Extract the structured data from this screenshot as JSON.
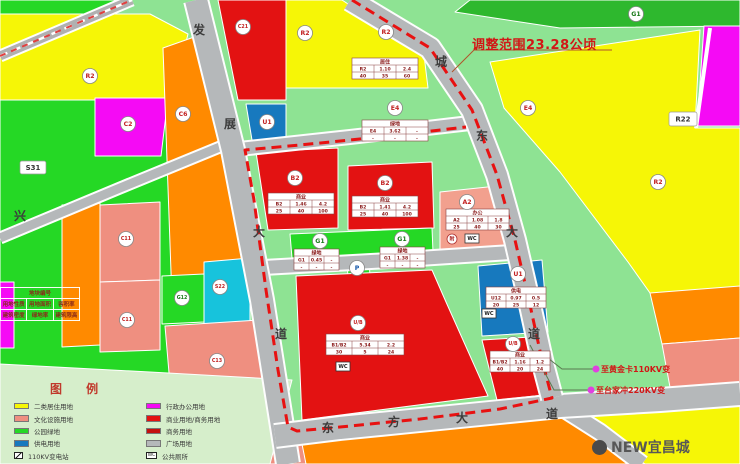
{
  "canvas": {
    "w": 740,
    "h": 464,
    "bg": "#8ee393"
  },
  "scope_note": {
    "text": "调整范围23.28公顷",
    "color": "#d21616"
  },
  "substation_notes": [
    {
      "text": "至黄金卡110KV变"
    },
    {
      "text": "至台家冲220KV变"
    }
  ],
  "watermark": {
    "text": "NEW宜昌城"
  },
  "legend": {
    "title": "图 例",
    "left": [
      {
        "type": "swatch",
        "color": "#f6f606",
        "label": "二类居住用地"
      },
      {
        "type": "swatch",
        "color": "#ef8f80",
        "label": "文化设施用地"
      },
      {
        "type": "swatch",
        "color": "#25d825",
        "label": "公园绿地"
      },
      {
        "type": "swatch",
        "color": "#1779be",
        "label": "供电用地"
      },
      {
        "type": "icon-substation",
        "glyph": "",
        "label": "110KV变电站"
      },
      {
        "type": "icon-pump",
        "glyph": "",
        "label": "泵站"
      }
    ],
    "right": [
      {
        "type": "swatch",
        "color": "#f50af5",
        "label": "行政办公用地"
      },
      {
        "type": "swatch",
        "color": "#e31212",
        "label": "商业用地/商务用地"
      },
      {
        "type": "swatch",
        "color": "#c40f0f",
        "label": "商务用地"
      },
      {
        "type": "swatch",
        "color": "#b5b8ba",
        "label": "广场用地"
      },
      {
        "type": "icon-wc",
        "glyph": "WC",
        "label": "公共厕所"
      },
      {
        "type": "icon-parking",
        "glyph": "P",
        "label": "社会公共停车场"
      }
    ]
  },
  "attr_table": {
    "header": "地块编号",
    "rows": [
      [
        "用地性质",
        "用地面积",
        "容积率"
      ],
      [
        "建筑密度",
        "绿地率",
        "建筑限高"
      ]
    ]
  },
  "map": {
    "parcels": [
      {
        "name": "green-top-left",
        "color": "#25d825",
        "pts": "0,0 132,0 100,14 0,14"
      },
      {
        "name": "green-strip-top-right",
        "color": "#2eb82e",
        "pts": "455,12 470,0 740,0 740,26 560,28"
      },
      {
        "name": "parkland-west",
        "color": "#25d825",
        "pts": "0,96 205,96 240,300 262,412 0,412"
      },
      {
        "name": "residential-top-left",
        "color": "#f6f606",
        "pts": "0,14 150,14 188,34 172,100 0,100"
      },
      {
        "name": "residential-top-center",
        "color": "#f6f606",
        "pts": "286,0 342,0 424,55 428,88 286,88"
      },
      {
        "name": "residential-east",
        "color": "#f6f606",
        "pts": "490,62 700,30 695,128 740,128 740,292 655,300 628,262 560,172 504,108"
      },
      {
        "name": "admin-magenta-east",
        "color": "#f50af5",
        "pts": "704,26 740,26 740,126 697,126"
      },
      {
        "name": "culture-C2",
        "color": "#f50af5",
        "pts": "95,98 168,98 161,156 95,156"
      },
      {
        "name": "education-C6",
        "color": "#ff8a00",
        "pts": "163,48 214,30 248,298 172,300"
      },
      {
        "name": "orange-west-strip",
        "color": "#ff8a00",
        "pts": "62,205 100,203 100,345 62,347"
      },
      {
        "name": "culture-C11-north",
        "color": "#ef8f80",
        "pts": "100,205 160,202 160,280 100,282"
      },
      {
        "name": "culture-C11-south",
        "color": "#ef8f80",
        "pts": "100,282 160,280 160,350 100,352"
      },
      {
        "name": "green-G12",
        "color": "#25d825",
        "pts": "162,276 204,274 204,322 162,324"
      },
      {
        "name": "utility-S22",
        "color": "#17c3dc",
        "pts": "204,262 250,258 250,322 204,324"
      },
      {
        "name": "culture-C13",
        "color": "#ef8f80",
        "pts": "165,326 258,320 268,406 172,408"
      },
      {
        "name": "magenta-west-sliver",
        "color": "#f50af5",
        "pts": "0,282 14,282 14,348 0,348"
      },
      {
        "name": "commercial-C21",
        "color": "#e31212",
        "pts": "218,0 286,0 286,100 238,100"
      },
      {
        "name": "utility-U1-north",
        "color": "#1779be",
        "pts": "246,104 286,104 286,140 252,140"
      },
      {
        "name": "commercial-B2-west",
        "color": "#e31212",
        "pts": "256,152 338,148 338,228 268,230"
      },
      {
        "name": "commercial-B2-east",
        "color": "#e31212",
        "pts": "348,166 432,162 434,228 348,230"
      },
      {
        "name": "office-A2",
        "color": "#f2a08e",
        "pts": "440,192 497,186 512,256 440,262"
      },
      {
        "name": "green-G1-strip",
        "color": "#25d825",
        "pts": "290,234 432,228 433,252 292,258"
      },
      {
        "name": "green-parking",
        "color": "#25d825",
        "pts": "347,258 369,257 370,278 348,279"
      },
      {
        "name": "commercial-UB-central",
        "color": "#e31212",
        "pts": "296,276 432,270 446,302 488,396 302,420"
      },
      {
        "name": "utility-U1-east",
        "color": "#1779be",
        "pts": "478,266 542,260 548,332 482,336"
      },
      {
        "name": "commercial-UB-east",
        "color": "#e31212",
        "pts": "482,340 548,336 553,394 497,400"
      },
      {
        "name": "orange-east",
        "color": "#ff8a00",
        "pts": "650,293 740,286 740,338 662,344"
      },
      {
        "name": "culture-east",
        "color": "#ef8f80",
        "pts": "662,344 740,338 740,394 672,398"
      },
      {
        "name": "residential-southeast",
        "color": "#f6f606",
        "pts": "558,408 740,394 740,464 645,464"
      },
      {
        "name": "orange-south",
        "color": "#ff8a00",
        "pts": "294,432 558,410 645,464 300,464"
      },
      {
        "name": "culture-south-sliver",
        "color": "#ef8f80",
        "pts": "262,448 302,444 306,464 262,464"
      },
      {
        "name": "legend-zone",
        "color": "#d6eecb",
        "pts": "0,364 150,372 292,380 270,464 0,464"
      }
    ],
    "roads": [
      {
        "name": "middle-road",
        "w": 12,
        "path": "230,150 350,137 470,123",
        "chars": []
      },
      {
        "name": "south-g1-road",
        "w": 13,
        "path": "254,268 380,261 518,252",
        "chars": []
      },
      {
        "name": "xing-road",
        "w": 9,
        "path": "0,238 120,188 232,142",
        "chars": [
          {
            "c": "兴",
            "x": 20,
            "y": 216
          }
        ]
      },
      {
        "name": "se-branch-road",
        "w": 15,
        "path": "556,404 600,432 642,464",
        "chars": []
      },
      {
        "name": "fazhan-avenue",
        "w": 22,
        "path": "196,0 233,150 262,300 288,464",
        "chars": [
          {
            "c": "发",
            "x": 199,
            "y": 30
          },
          {
            "c": "展",
            "x": 230,
            "y": 124
          },
          {
            "c": "大",
            "x": 259,
            "y": 232
          },
          {
            "c": "道",
            "x": 281,
            "y": 334
          }
        ]
      },
      {
        "name": "dongfang-avenue",
        "w": 22,
        "path": "275,436 340,428 420,420 500,412 560,406 660,400 740,394",
        "chars": [
          {
            "c": "东",
            "x": 328,
            "y": 428
          },
          {
            "c": "方",
            "x": 394,
            "y": 422
          },
          {
            "c": "大",
            "x": 462,
            "y": 418
          },
          {
            "c": "道",
            "x": 552,
            "y": 414
          }
        ]
      },
      {
        "name": "chengdong-avenue",
        "w": 20,
        "path": "350,0 430,48 472,110 497,175 515,240 530,305 542,360 552,398",
        "chars": [
          {
            "c": "城",
            "x": 441,
            "y": 62
          },
          {
            "c": "东",
            "x": 482,
            "y": 136
          },
          {
            "c": "大",
            "x": 512,
            "y": 232
          },
          {
            "c": "道",
            "x": 534,
            "y": 334
          }
        ]
      },
      {
        "name": "white-divider",
        "w": 4,
        "path": "710,28 696,128",
        "plain": "#ffffff",
        "chars": []
      }
    ],
    "rail": {
      "path": "0,56 132,0"
    },
    "boundary": {
      "color": "#e81111",
      "path": "352,0 430,48 472,110 497,175 515,240 530,305 542,360 552,398 500,409 420,419 340,427 297,431 288,427 278,370 266,290 254,200 245,150 300,145 380,137 466,127"
    },
    "circles": [
      {
        "label": "R2",
        "x": 90,
        "y": 76
      },
      {
        "label": "C2",
        "x": 128,
        "y": 124
      },
      {
        "label": "C6",
        "x": 183,
        "y": 114
      },
      {
        "label": "C21",
        "x": 243,
        "y": 27
      },
      {
        "label": "U1",
        "x": 267,
        "y": 122
      },
      {
        "label": "R2",
        "x": 305,
        "y": 33
      },
      {
        "label": "R2",
        "x": 386,
        "y": 32
      },
      {
        "label": "G1",
        "x": 636,
        "y": 14,
        "tc": "#1a7a1a"
      },
      {
        "label": "R2",
        "x": 658,
        "y": 182
      },
      {
        "label": "E4",
        "x": 395,
        "y": 108
      },
      {
        "label": "E4",
        "x": 528,
        "y": 108
      },
      {
        "label": "B2",
        "x": 295,
        "y": 178
      },
      {
        "label": "B2",
        "x": 385,
        "y": 183
      },
      {
        "label": "A2",
        "x": 467,
        "y": 202
      },
      {
        "label": "G1",
        "x": 320,
        "y": 241,
        "tc": "#1a7a1a"
      },
      {
        "label": "G1",
        "x": 402,
        "y": 239,
        "tc": "#1a7a1a"
      },
      {
        "label": "U1",
        "x": 518,
        "y": 274
      },
      {
        "label": "U/B",
        "x": 513,
        "y": 344
      },
      {
        "label": "U/B",
        "x": 358,
        "y": 323
      },
      {
        "label": "C11",
        "x": 126,
        "y": 239
      },
      {
        "label": "C11",
        "x": 127,
        "y": 320
      },
      {
        "label": "G12",
        "x": 182,
        "y": 298,
        "tc": "#1a7a1a"
      },
      {
        "label": "S22",
        "x": 220,
        "y": 287
      },
      {
        "label": "C13",
        "x": 217,
        "y": 361
      },
      {
        "label": "P",
        "x": 357,
        "y": 268,
        "tc": "#1356a8"
      }
    ],
    "tables": [
      {
        "x": 352,
        "y": 58,
        "cw": 22,
        "header": "居住",
        "r1": [
          "R2",
          "1.10",
          "2.4"
        ],
        "r2": [
          "40",
          "35",
          "60"
        ]
      },
      {
        "x": 362,
        "y": 120,
        "cw": 22,
        "header": "绿地",
        "r1": [
          "E4",
          "3.62",
          "-"
        ],
        "r2": [
          "-",
          "-",
          "-"
        ]
      },
      {
        "x": 268,
        "y": 193,
        "cw": 22,
        "header": "商业",
        "r1": [
          "B2",
          "1.46",
          "4.2"
        ],
        "r2": [
          "25",
          "40",
          "100"
        ]
      },
      {
        "x": 352,
        "y": 196,
        "cw": 22,
        "header": "商业",
        "r1": [
          "B2",
          "1.41",
          "4.2"
        ],
        "r2": [
          "25",
          "40",
          "100"
        ]
      },
      {
        "x": 446,
        "y": 209,
        "cw": 21,
        "header": "办公",
        "r1": [
          "A2",
          "1.08",
          "1.8"
        ],
        "r2": [
          "25",
          "40",
          "30"
        ]
      },
      {
        "x": 294,
        "y": 249,
        "cw": 15,
        "header": "绿地",
        "r1": [
          "G1",
          "0.45",
          "-"
        ],
        "r2": [
          "-",
          "-",
          "-"
        ]
      },
      {
        "x": 380,
        "y": 247,
        "cw": 15,
        "header": "绿地",
        "r1": [
          "G1",
          "1.38",
          "-"
        ],
        "r2": [
          "-",
          "-",
          "-"
        ]
      },
      {
        "x": 486,
        "y": 287,
        "cw": 20,
        "header": "供电",
        "r1": [
          "U12",
          "0.97",
          "0.5"
        ],
        "r2": [
          "20",
          "25",
          "12"
        ]
      },
      {
        "x": 490,
        "y": 351,
        "cw": 20,
        "header": "商业",
        "r1": [
          "B1/B2",
          "1.16",
          "1.2"
        ],
        "r2": [
          "40",
          "20",
          "24"
        ]
      },
      {
        "x": 326,
        "y": 334,
        "cw": 26,
        "header": "商业",
        "r1": [
          "B1/B2",
          "5.34",
          "2.2"
        ],
        "r2": [
          "30",
          "5",
          "24"
        ]
      }
    ],
    "boxes": [
      {
        "text": "S31",
        "x": 20,
        "y": 161,
        "w": 26,
        "h": 13
      },
      {
        "text": "R22",
        "x": 669,
        "y": 112,
        "w": 28,
        "h": 14
      }
    ],
    "icons": [
      {
        "t": "fu",
        "x": 452,
        "y": 239
      },
      {
        "t": "wc",
        "x": 465,
        "y": 234
      },
      {
        "t": "wc",
        "x": 336,
        "y": 362
      },
      {
        "t": "wc",
        "x": 482,
        "y": 309
      }
    ],
    "leaders": [
      {
        "pts": "452,72 474,50 612,50",
        "color": "#b0542a"
      },
      {
        "pts": "540,352 562,369 596,369",
        "color": "#5a7a50"
      },
      {
        "pts": "530,345 554,390 591,390",
        "color": "#5a7a50"
      }
    ],
    "dots": [
      {
        "x": 596,
        "y": 369
      },
      {
        "x": 591,
        "y": 390
      }
    ]
  }
}
